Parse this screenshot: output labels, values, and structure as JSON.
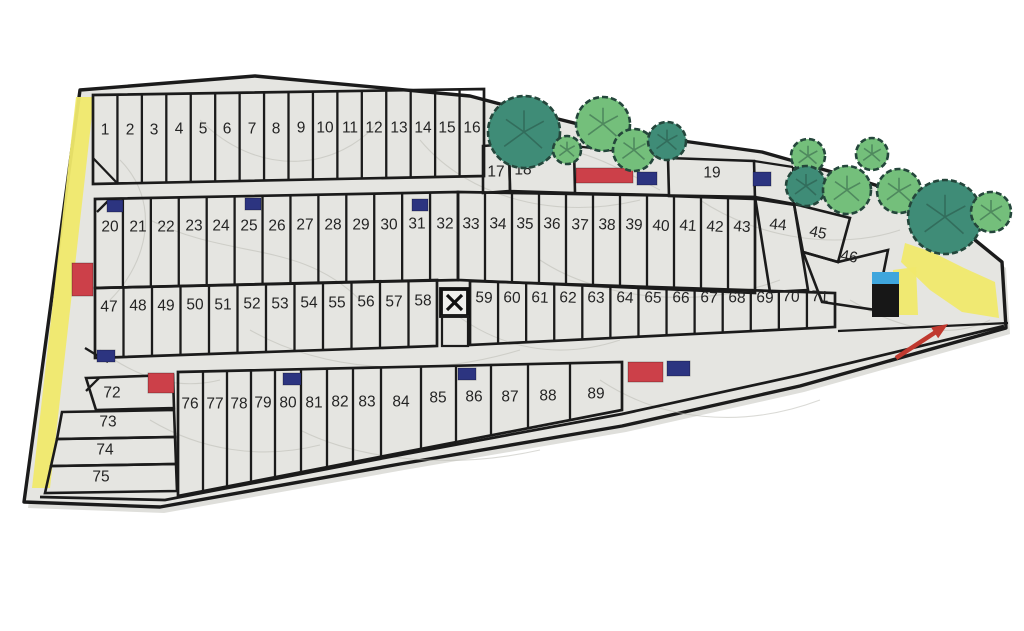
{
  "map": {
    "title": "lot-site-plan",
    "colors": {
      "paper": "#e5e5e1",
      "line": "#1b1b1b",
      "number": "#242424",
      "red": "#cc4049",
      "blue": "#2c3480",
      "yellow": "#f0e96c",
      "black": "#171717",
      "roof_blue": "#3fa6dd",
      "tree_dark": "#3f8c77",
      "tree_light": "#74bf7b",
      "tree_stroke": "#24463b",
      "arrow": "#c0392f",
      "shadow": "#c9c9c3",
      "texture": "#bcbcb4"
    },
    "outer_boundary": [
      [
        80,
        90
      ],
      [
        255,
        76
      ],
      [
        470,
        96
      ],
      [
        530,
        112
      ],
      [
        602,
        130
      ],
      [
        690,
        142
      ],
      [
        762,
        152
      ],
      [
        860,
        180
      ],
      [
        945,
        208
      ],
      [
        975,
        240
      ],
      [
        1002,
        262
      ],
      [
        1006,
        328
      ],
      [
        800,
        386
      ],
      [
        622,
        426
      ],
      [
        400,
        464
      ],
      [
        160,
        507
      ],
      [
        24,
        502
      ]
    ],
    "road_line": [
      [
        40,
        497
      ],
      [
        165,
        500
      ],
      [
        400,
        455
      ],
      [
        622,
        414
      ],
      [
        800,
        375
      ],
      [
        1004,
        326
      ]
    ],
    "yellow_areas": [
      {
        "name": "yellow-path-left",
        "points": [
          [
            76,
            97
          ],
          [
            94,
            97
          ],
          [
            50,
            488
          ],
          [
            32,
            488
          ]
        ]
      },
      {
        "name": "yellow-path-right",
        "points": [
          [
            905,
            243
          ],
          [
            932,
            252
          ],
          [
            964,
            268
          ],
          [
            995,
            282
          ],
          [
            999,
            318
          ],
          [
            962,
            312
          ],
          [
            930,
            290
          ],
          [
            901,
            262
          ]
        ]
      },
      {
        "name": "yellow-patch-building",
        "points": [
          [
            893,
            270
          ],
          [
            916,
            267
          ],
          [
            918,
            315
          ],
          [
            893,
            315
          ]
        ]
      }
    ],
    "bands": [
      {
        "id": "band-lots-1-16",
        "x0": 93,
        "x1": 484,
        "t0": 95,
        "t1": 89,
        "b0": 184,
        "b1": 176,
        "n": 16
      },
      {
        "id": "band-lots-20-32",
        "x0": 95,
        "x1": 458,
        "t0": 199,
        "t1": 192,
        "b0": 288,
        "b1": 280,
        "n": 13
      },
      {
        "id": "band-lots-33-43",
        "x0": 458,
        "x1": 755,
        "t0": 192,
        "t1": 197,
        "b0": 280,
        "b1": 293,
        "n": 11
      },
      {
        "id": "band-lots-47-58",
        "x0": 95,
        "x1": 437,
        "t0": 288,
        "t1": 280,
        "b0": 358,
        "b1": 346,
        "n": 12
      },
      {
        "id": "band-lots-59-71",
        "x0": 470,
        "x1": 835,
        "t0": 281,
        "t1": 293,
        "b0": 345,
        "b1": 327,
        "n": 13
      }
    ],
    "band_e": {
      "id": "band-lots-76-89",
      "edges": [
        178,
        203,
        227,
        251,
        275,
        301,
        327,
        353,
        381,
        421,
        456,
        491,
        528,
        570,
        622
      ],
      "t0": 372,
      "t1": 362,
      "b0": 496,
      "b1": 410
    },
    "cells": [
      {
        "name": "lot-cell-17",
        "points": [
          [
            483,
            146
          ],
          [
            509,
            144
          ],
          [
            510,
            191
          ],
          [
            483,
            193
          ]
        ]
      },
      {
        "name": "lot-cell-18",
        "points": [
          [
            509,
            144
          ],
          [
            574,
            147
          ],
          [
            575,
            193
          ],
          [
            510,
            191
          ]
        ]
      },
      {
        "name": "lot-cell-19",
        "points": [
          [
            668,
            158
          ],
          [
            754,
            161
          ],
          [
            755,
            199
          ],
          [
            669,
            196
          ]
        ]
      },
      {
        "name": "lot-cell-44",
        "points": [
          [
            755,
            197
          ],
          [
            794,
            204
          ],
          [
            808,
            290
          ],
          [
            770,
            292
          ]
        ]
      },
      {
        "name": "lot-cell-45",
        "points": [
          [
            794,
            204
          ],
          [
            850,
            218
          ],
          [
            838,
            262
          ],
          [
            803,
            252
          ]
        ]
      },
      {
        "name": "lot-cell-46",
        "points": [
          [
            803,
            252
          ],
          [
            838,
            262
          ],
          [
            888,
            250
          ],
          [
            876,
            310
          ],
          [
            822,
            302
          ]
        ]
      },
      {
        "name": "lot-cell-72",
        "points": [
          [
            86,
            378
          ],
          [
            173,
            375
          ],
          [
            174,
            408
          ],
          [
            96,
            410
          ]
        ]
      },
      {
        "name": "lot-cell-73",
        "points": [
          [
            62,
            412
          ],
          [
            174,
            410
          ],
          [
            175,
            437
          ],
          [
            57,
            439
          ]
        ]
      },
      {
        "name": "lot-cell-74",
        "points": [
          [
            57,
            439
          ],
          [
            175,
            437
          ],
          [
            176,
            464
          ],
          [
            51,
            466
          ]
        ]
      },
      {
        "name": "lot-cell-75",
        "points": [
          [
            51,
            466
          ],
          [
            176,
            464
          ],
          [
            177,
            491
          ],
          [
            45,
            493
          ]
        ]
      }
    ],
    "extra_lines": [
      [
        574,
        146,
        668,
        157
      ],
      [
        754,
        161,
        793,
        167
      ],
      [
        575,
        193,
        668,
        195
      ],
      [
        755,
        199,
        794,
        205
      ],
      [
        793,
        167,
        794,
        205
      ],
      [
        93,
        158,
        118,
        184
      ],
      [
        97,
        212,
        108,
        201
      ],
      [
        85,
        348,
        108,
        362
      ],
      [
        86,
        391,
        99,
        378
      ],
      [
        838,
        331,
        1008,
        323
      ]
    ],
    "markers": [
      {
        "x": 576,
        "y": 168,
        "w": 57,
        "h": 15,
        "c": "red"
      },
      {
        "x": 637,
        "y": 172,
        "w": 20,
        "h": 13,
        "c": "blue"
      },
      {
        "x": 753,
        "y": 172,
        "w": 18,
        "h": 14,
        "c": "blue"
      },
      {
        "x": 107,
        "y": 200,
        "w": 16,
        "h": 12,
        "c": "blue"
      },
      {
        "x": 245,
        "y": 198,
        "w": 16,
        "h": 12,
        "c": "blue"
      },
      {
        "x": 412,
        "y": 199,
        "w": 16,
        "h": 12,
        "c": "blue"
      },
      {
        "x": 72,
        "y": 263,
        "w": 21,
        "h": 33,
        "c": "red"
      },
      {
        "x": 97,
        "y": 350,
        "w": 18,
        "h": 12,
        "c": "blue"
      },
      {
        "x": 148,
        "y": 373,
        "w": 26,
        "h": 20,
        "c": "red"
      },
      {
        "x": 283,
        "y": 373,
        "w": 18,
        "h": 12,
        "c": "blue"
      },
      {
        "x": 458,
        "y": 368,
        "w": 18,
        "h": 12,
        "c": "blue"
      },
      {
        "x": 628,
        "y": 362,
        "w": 35,
        "h": 20,
        "c": "red"
      },
      {
        "x": 667,
        "y": 361,
        "w": 23,
        "h": 15,
        "c": "blue"
      }
    ],
    "building": {
      "x": 872,
      "y": 272,
      "w": 27,
      "roof_h": 12,
      "body_h": 33
    },
    "x_symbol": {
      "x": 441,
      "y": 289,
      "s": 27
    },
    "notch": {
      "x": 442,
      "y": 316,
      "w": 26,
      "h": 30
    },
    "arrow": {
      "x1": 896,
      "y1": 358,
      "x2": 948,
      "y2": 324
    },
    "trees": [
      {
        "x": 524,
        "y": 132,
        "r": 36,
        "s": "dark"
      },
      {
        "x": 567,
        "y": 150,
        "r": 14,
        "s": "light"
      },
      {
        "x": 603,
        "y": 124,
        "r": 27,
        "s": "light"
      },
      {
        "x": 634,
        "y": 150,
        "r": 21,
        "s": "light"
      },
      {
        "x": 667,
        "y": 141,
        "r": 19,
        "s": "dark"
      },
      {
        "x": 808,
        "y": 156,
        "r": 17,
        "s": "light"
      },
      {
        "x": 806,
        "y": 186,
        "r": 20,
        "s": "dark"
      },
      {
        "x": 847,
        "y": 190,
        "r": 24,
        "s": "light"
      },
      {
        "x": 872,
        "y": 154,
        "r": 16,
        "s": "light"
      },
      {
        "x": 899,
        "y": 191,
        "r": 22,
        "s": "light"
      },
      {
        "x": 945,
        "y": 217,
        "r": 37,
        "s": "dark"
      },
      {
        "x": 991,
        "y": 212,
        "r": 20,
        "s": "light"
      }
    ],
    "lots": [
      {
        "n": "1",
        "x": 105,
        "y": 130
      },
      {
        "n": "2",
        "x": 130,
        "y": 130
      },
      {
        "n": "3",
        "x": 154,
        "y": 130
      },
      {
        "n": "4",
        "x": 179,
        "y": 129
      },
      {
        "n": "5",
        "x": 203,
        "y": 129
      },
      {
        "n": "6",
        "x": 227,
        "y": 129
      },
      {
        "n": "7",
        "x": 252,
        "y": 129
      },
      {
        "n": "8",
        "x": 276,
        "y": 129
      },
      {
        "n": "9",
        "x": 301,
        "y": 128
      },
      {
        "n": "10",
        "x": 325,
        "y": 128
      },
      {
        "n": "11",
        "x": 350,
        "y": 128
      },
      {
        "n": "12",
        "x": 374,
        "y": 128
      },
      {
        "n": "13",
        "x": 399,
        "y": 128
      },
      {
        "n": "14",
        "x": 423,
        "y": 128
      },
      {
        "n": "15",
        "x": 447,
        "y": 128
      },
      {
        "n": "16",
        "x": 472,
        "y": 128
      },
      {
        "n": "17",
        "x": 496,
        "y": 172
      },
      {
        "n": "18",
        "x": 523,
        "y": 170
      },
      {
        "n": "19",
        "x": 712,
        "y": 173
      },
      {
        "n": "20",
        "x": 110,
        "y": 227
      },
      {
        "n": "21",
        "x": 138,
        "y": 227
      },
      {
        "n": "22",
        "x": 166,
        "y": 227
      },
      {
        "n": "23",
        "x": 194,
        "y": 226
      },
      {
        "n": "24",
        "x": 221,
        "y": 226
      },
      {
        "n": "25",
        "x": 249,
        "y": 226
      },
      {
        "n": "26",
        "x": 277,
        "y": 226
      },
      {
        "n": "27",
        "x": 305,
        "y": 225
      },
      {
        "n": "28",
        "x": 333,
        "y": 225
      },
      {
        "n": "29",
        "x": 361,
        "y": 225
      },
      {
        "n": "30",
        "x": 389,
        "y": 225
      },
      {
        "n": "31",
        "x": 417,
        "y": 224
      },
      {
        "n": "32",
        "x": 445,
        "y": 224
      },
      {
        "n": "33",
        "x": 471,
        "y": 224,
        "r": 4
      },
      {
        "n": "34",
        "x": 498,
        "y": 224,
        "r": 4
      },
      {
        "n": "35",
        "x": 525,
        "y": 224,
        "r": 4
      },
      {
        "n": "36",
        "x": 552,
        "y": 224,
        "r": 4
      },
      {
        "n": "37",
        "x": 580,
        "y": 225,
        "r": 4
      },
      {
        "n": "38",
        "x": 607,
        "y": 225,
        "r": 4
      },
      {
        "n": "39",
        "x": 634,
        "y": 225,
        "r": 4
      },
      {
        "n": "40",
        "x": 661,
        "y": 226,
        "r": 4
      },
      {
        "n": "41",
        "x": 688,
        "y": 226,
        "r": 4
      },
      {
        "n": "42",
        "x": 715,
        "y": 227,
        "r": 4
      },
      {
        "n": "43",
        "x": 742,
        "y": 227,
        "r": 4
      },
      {
        "n": "44",
        "x": 778,
        "y": 225,
        "r": 6
      },
      {
        "n": "45",
        "x": 818,
        "y": 233,
        "r": 12
      },
      {
        "n": "46",
        "x": 849,
        "y": 257,
        "r": 10
      },
      {
        "n": "47",
        "x": 109,
        "y": 307
      },
      {
        "n": "48",
        "x": 138,
        "y": 306
      },
      {
        "n": "49",
        "x": 166,
        "y": 306
      },
      {
        "n": "50",
        "x": 195,
        "y": 305
      },
      {
        "n": "51",
        "x": 223,
        "y": 305
      },
      {
        "n": "52",
        "x": 252,
        "y": 304
      },
      {
        "n": "53",
        "x": 280,
        "y": 304
      },
      {
        "n": "54",
        "x": 309,
        "y": 303
      },
      {
        "n": "55",
        "x": 337,
        "y": 303
      },
      {
        "n": "56",
        "x": 366,
        "y": 302
      },
      {
        "n": "57",
        "x": 394,
        "y": 302
      },
      {
        "n": "58",
        "x": 423,
        "y": 301
      },
      {
        "n": "59",
        "x": 484,
        "y": 298,
        "r": 3
      },
      {
        "n": "60",
        "x": 512,
        "y": 298,
        "r": 3
      },
      {
        "n": "61",
        "x": 540,
        "y": 298,
        "r": 3
      },
      {
        "n": "62",
        "x": 568,
        "y": 298,
        "r": 3
      },
      {
        "n": "63",
        "x": 596,
        "y": 298,
        "r": 3
      },
      {
        "n": "64",
        "x": 625,
        "y": 298,
        "r": 3
      },
      {
        "n": "65",
        "x": 653,
        "y": 298,
        "r": 3
      },
      {
        "n": "66",
        "x": 681,
        "y": 298,
        "r": 3
      },
      {
        "n": "67",
        "x": 709,
        "y": 298,
        "r": 3
      },
      {
        "n": "68",
        "x": 737,
        "y": 298,
        "r": 3
      },
      {
        "n": "69",
        "x": 765,
        "y": 298,
        "r": 3
      },
      {
        "n": "70",
        "x": 791,
        "y": 297,
        "r": 3
      },
      {
        "n": "71",
        "x": 820,
        "y": 297,
        "r": 3
      },
      {
        "n": "72",
        "x": 112,
        "y": 393
      },
      {
        "n": "73",
        "x": 108,
        "y": 422
      },
      {
        "n": "74",
        "x": 105,
        "y": 450
      },
      {
        "n": "75",
        "x": 101,
        "y": 477
      },
      {
        "n": "76",
        "x": 190,
        "y": 404
      },
      {
        "n": "77",
        "x": 215,
        "y": 404
      },
      {
        "n": "78",
        "x": 239,
        "y": 404
      },
      {
        "n": "79",
        "x": 263,
        "y": 403
      },
      {
        "n": "80",
        "x": 288,
        "y": 403
      },
      {
        "n": "81",
        "x": 314,
        "y": 403
      },
      {
        "n": "82",
        "x": 340,
        "y": 402
      },
      {
        "n": "83",
        "x": 367,
        "y": 402
      },
      {
        "n": "84",
        "x": 401,
        "y": 402
      },
      {
        "n": "85",
        "x": 438,
        "y": 398
      },
      {
        "n": "86",
        "x": 474,
        "y": 397
      },
      {
        "n": "87",
        "x": 510,
        "y": 397
      },
      {
        "n": "88",
        "x": 548,
        "y": 396
      },
      {
        "n": "89",
        "x": 596,
        "y": 394
      }
    ]
  }
}
